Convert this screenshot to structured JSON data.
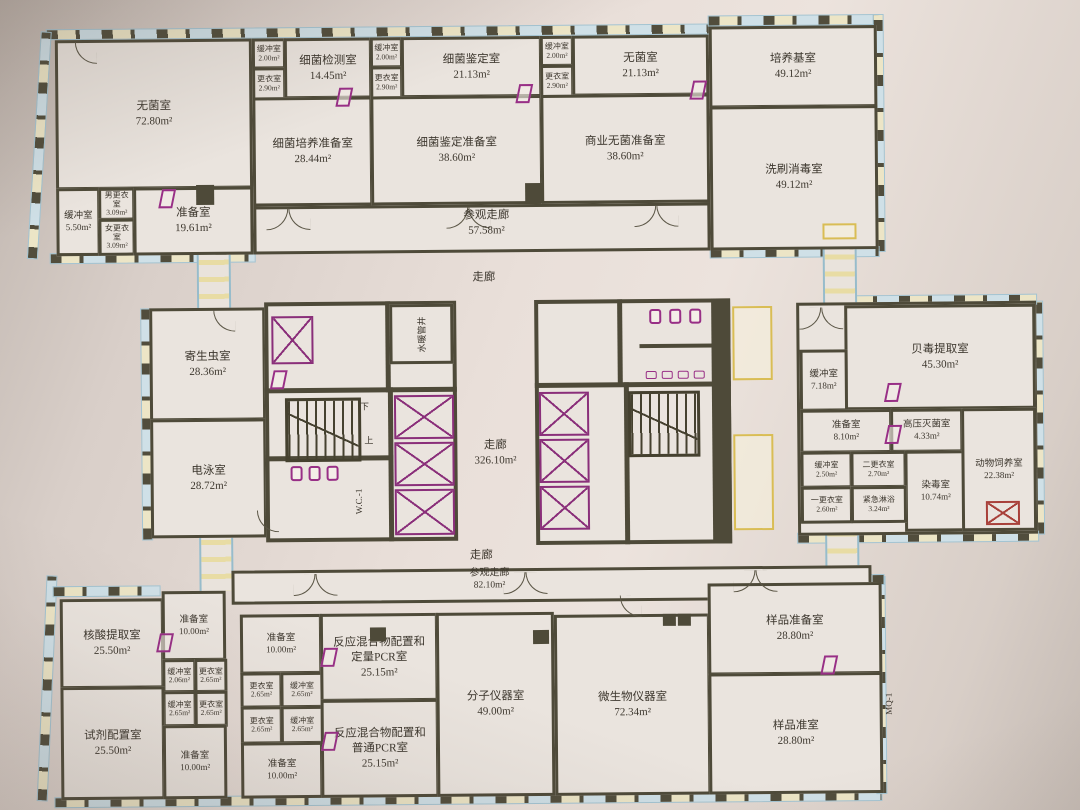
{
  "colors": {
    "wall": "#4e4a39",
    "fixture_magenta": "#982f86",
    "window_blue": "#9cc0d0",
    "detail_yellow": "#d9bd55",
    "paper": "#eae4de"
  },
  "corridors": {
    "visit_top": {
      "name": "参观走廊",
      "area": "57.58m²"
    },
    "hall_top": {
      "name": "走廊"
    },
    "hall_main": {
      "name": "走廊",
      "area": "326.10m²"
    },
    "hall_bottom": {
      "name": "走廊"
    },
    "visit_bottom": {
      "name": "参观走廊",
      "area": "82.10m²"
    }
  },
  "labels": {
    "pipe_shaft": "水暖管井",
    "wc": "W.C.-1",
    "stair_up": "上",
    "stair_down": "下",
    "mq": "MQ-1"
  },
  "rooms": [
    {
      "name": "无菌室",
      "area": "72.80m²"
    },
    {
      "name": "缓冲室",
      "area": "2.00m²"
    },
    {
      "name": "更衣室",
      "area": "2.90m²"
    },
    {
      "name": "细菌检测室",
      "area": "14.45m²"
    },
    {
      "name": "细菌培养准备室",
      "area": "28.44m²"
    },
    {
      "name": "缓冲室",
      "area": "2.00m²"
    },
    {
      "name": "更衣室",
      "area": "2.90m²"
    },
    {
      "name": "细菌鉴定室",
      "area": "21.13m²"
    },
    {
      "name": "细菌鉴定准备室",
      "area": "38.60m²"
    },
    {
      "name": "缓冲室",
      "area": "2.00m²"
    },
    {
      "name": "更衣室",
      "area": "2.90m²"
    },
    {
      "name": "无菌室",
      "area": "21.13m²"
    },
    {
      "name": "商业无菌准备室",
      "area": "38.60m²"
    },
    {
      "name": "培养基室",
      "area": "49.12m²"
    },
    {
      "name": "洗刷消毒室",
      "area": "49.12m²"
    },
    {
      "name": "缓冲室",
      "area": "5.50m²"
    },
    {
      "name": "男更衣室",
      "area": "3.09m²"
    },
    {
      "name": "女更衣室",
      "area": "3.09m²"
    },
    {
      "name": "准备室",
      "area": "19.61m²"
    },
    {
      "name": "寄生虫室",
      "area": "28.36m²"
    },
    {
      "name": "电泳室",
      "area": "28.72m²"
    },
    {
      "name": "贝毒提取室",
      "area": "45.30m²"
    },
    {
      "name": "缓冲室",
      "area": "7.18m²"
    },
    {
      "name": "准备室",
      "area": "8.10m²"
    },
    {
      "name": "高压灭菌室",
      "area": "4.33m²"
    },
    {
      "name": "缓冲室",
      "area": "2.50m²"
    },
    {
      "name": "二更衣室",
      "area": "2.70m²"
    },
    {
      "name": "染毒室",
      "area": "10.74m²"
    },
    {
      "name": "动物饲养室",
      "area": "22.38m²"
    },
    {
      "name": "一更衣室",
      "area": "2.60m²"
    },
    {
      "name": "紧急淋浴",
      "area": "3.24m²"
    },
    {
      "name": "核酸提取室",
      "area": "25.50m²"
    },
    {
      "name": "准备室",
      "area": "10.00m²"
    },
    {
      "name": "缓冲室",
      "area": "2.06m²"
    },
    {
      "name": "更衣室",
      "area": "2.65m²"
    },
    {
      "name": "缓冲室",
      "area": "2.65m²"
    },
    {
      "name": "更衣室",
      "area": "2.65m²"
    },
    {
      "name": "试剂配置室",
      "area": "25.50m²"
    },
    {
      "name": "准备室",
      "area": "10.00m²"
    },
    {
      "name": "准备室",
      "area": "10.00m²"
    },
    {
      "name": "更衣室",
      "area": "2.65m²"
    },
    {
      "name": "缓冲室",
      "area": "2.65m²"
    },
    {
      "name": "更衣室",
      "area": "2.65m²"
    },
    {
      "name": "缓冲室",
      "area": "2.65m²"
    },
    {
      "name": "准备室",
      "area": "10.00m²"
    },
    {
      "name": "反应混合物配置和定量PCR室",
      "area": "25.15m²"
    },
    {
      "name": "反应混合物配置和普通PCR室",
      "area": "25.15m²"
    },
    {
      "name": "分子仪器室",
      "area": "49.00m²"
    },
    {
      "name": "微生物仪器室",
      "area": "72.34m²"
    },
    {
      "name": "样品准备室",
      "area": "28.80m²"
    },
    {
      "name": "样品准室",
      "area": "28.80m²"
    }
  ]
}
